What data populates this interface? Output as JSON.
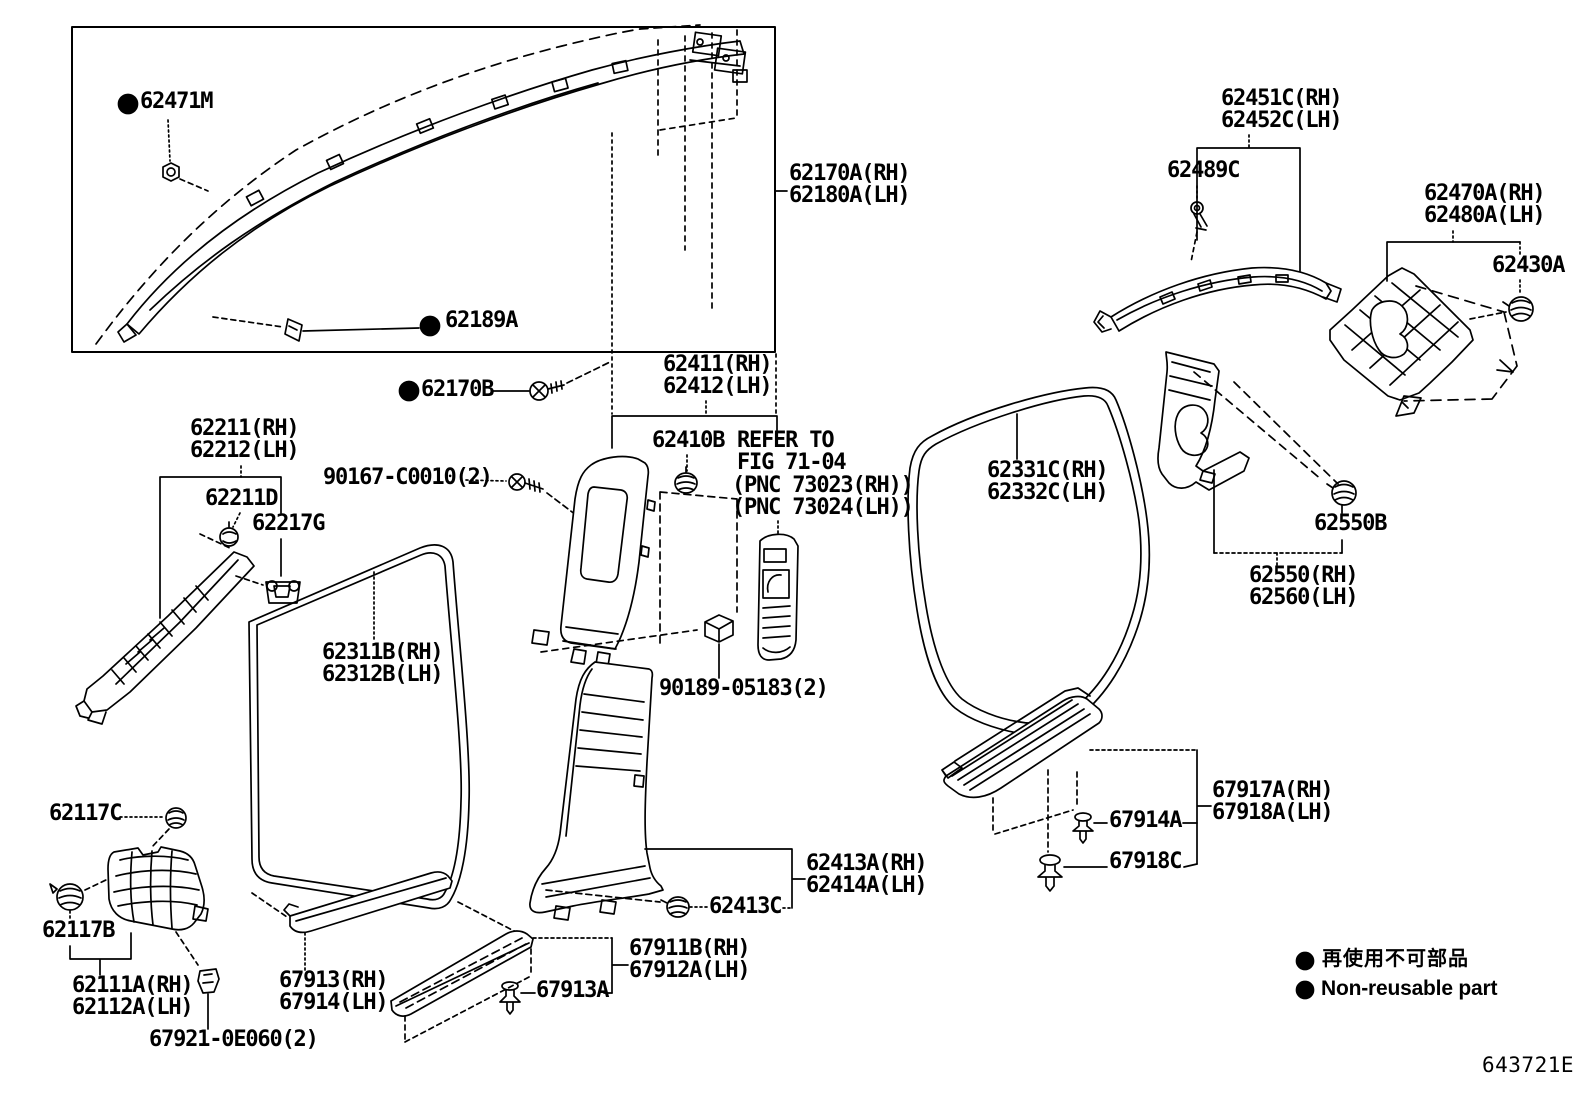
{
  "page": {
    "background": "#ffffff",
    "ink": "#000000"
  },
  "callouts": {
    "c62471M": "62471M",
    "c62189A": "62189A",
    "c62170A_rh": "62170A(RH)",
    "c62180A_lh": "62180A(LH)",
    "c62170B": "62170B",
    "c62211_rh": "62211(RH)",
    "c62212_lh": "62212(LH)",
    "c62211D": "62211D",
    "c62217G": "62217G",
    "c90167": "90167-C0010(2)",
    "c62411_rh": "62411(RH)",
    "c62412_lh": "62412(LH)",
    "c62410B": "62410B",
    "c62451C_rh": "62451C(RH)",
    "c62452C_lh": "62452C(LH)",
    "c62489C": "62489C",
    "c62470A_rh": "62470A(RH)",
    "c62480A_lh": "62480A(LH)",
    "c62430A": "62430A",
    "c62331C_rh": "62331C(RH)",
    "c62332C_lh": "62332C(LH)",
    "c62550B": "62550B",
    "c62550_rh": "62550(RH)",
    "c62560_lh": "62560(LH)",
    "c62311B_rh": "62311B(RH)",
    "c62312B_lh": "62312B(LH)",
    "c90189": "90189-05183(2)",
    "c62117C": "62117C",
    "c62117B": "62117B",
    "c62111A_rh": "62111A(RH)",
    "c62112A_lh": "62112A(LH)",
    "c67921": "67921-0E060(2)",
    "c67913_rh": "67913(RH)",
    "c67914_lh": "67914(LH)",
    "c67913A": "67913A",
    "c67911B_rh": "67911B(RH)",
    "c67912A_lh": "67912A(LH)",
    "c62413A_rh": "62413A(RH)",
    "c62414A_lh": "62414A(LH)",
    "c62413C": "62413C",
    "c67917A_rh": "67917A(RH)",
    "c67918A_lh": "67918A(LH)",
    "c67914A": "67914A",
    "c67918C": "67918C"
  },
  "note": {
    "line1": "REFER TO",
    "line2": "FIG 71-04",
    "line3": "(PNC 73023(RH))",
    "line4": "(PNC 73024(LH))"
  },
  "legend": {
    "jp": "再使用不可部品",
    "en": "Non-reusable part"
  },
  "diagram_code": "643721E"
}
